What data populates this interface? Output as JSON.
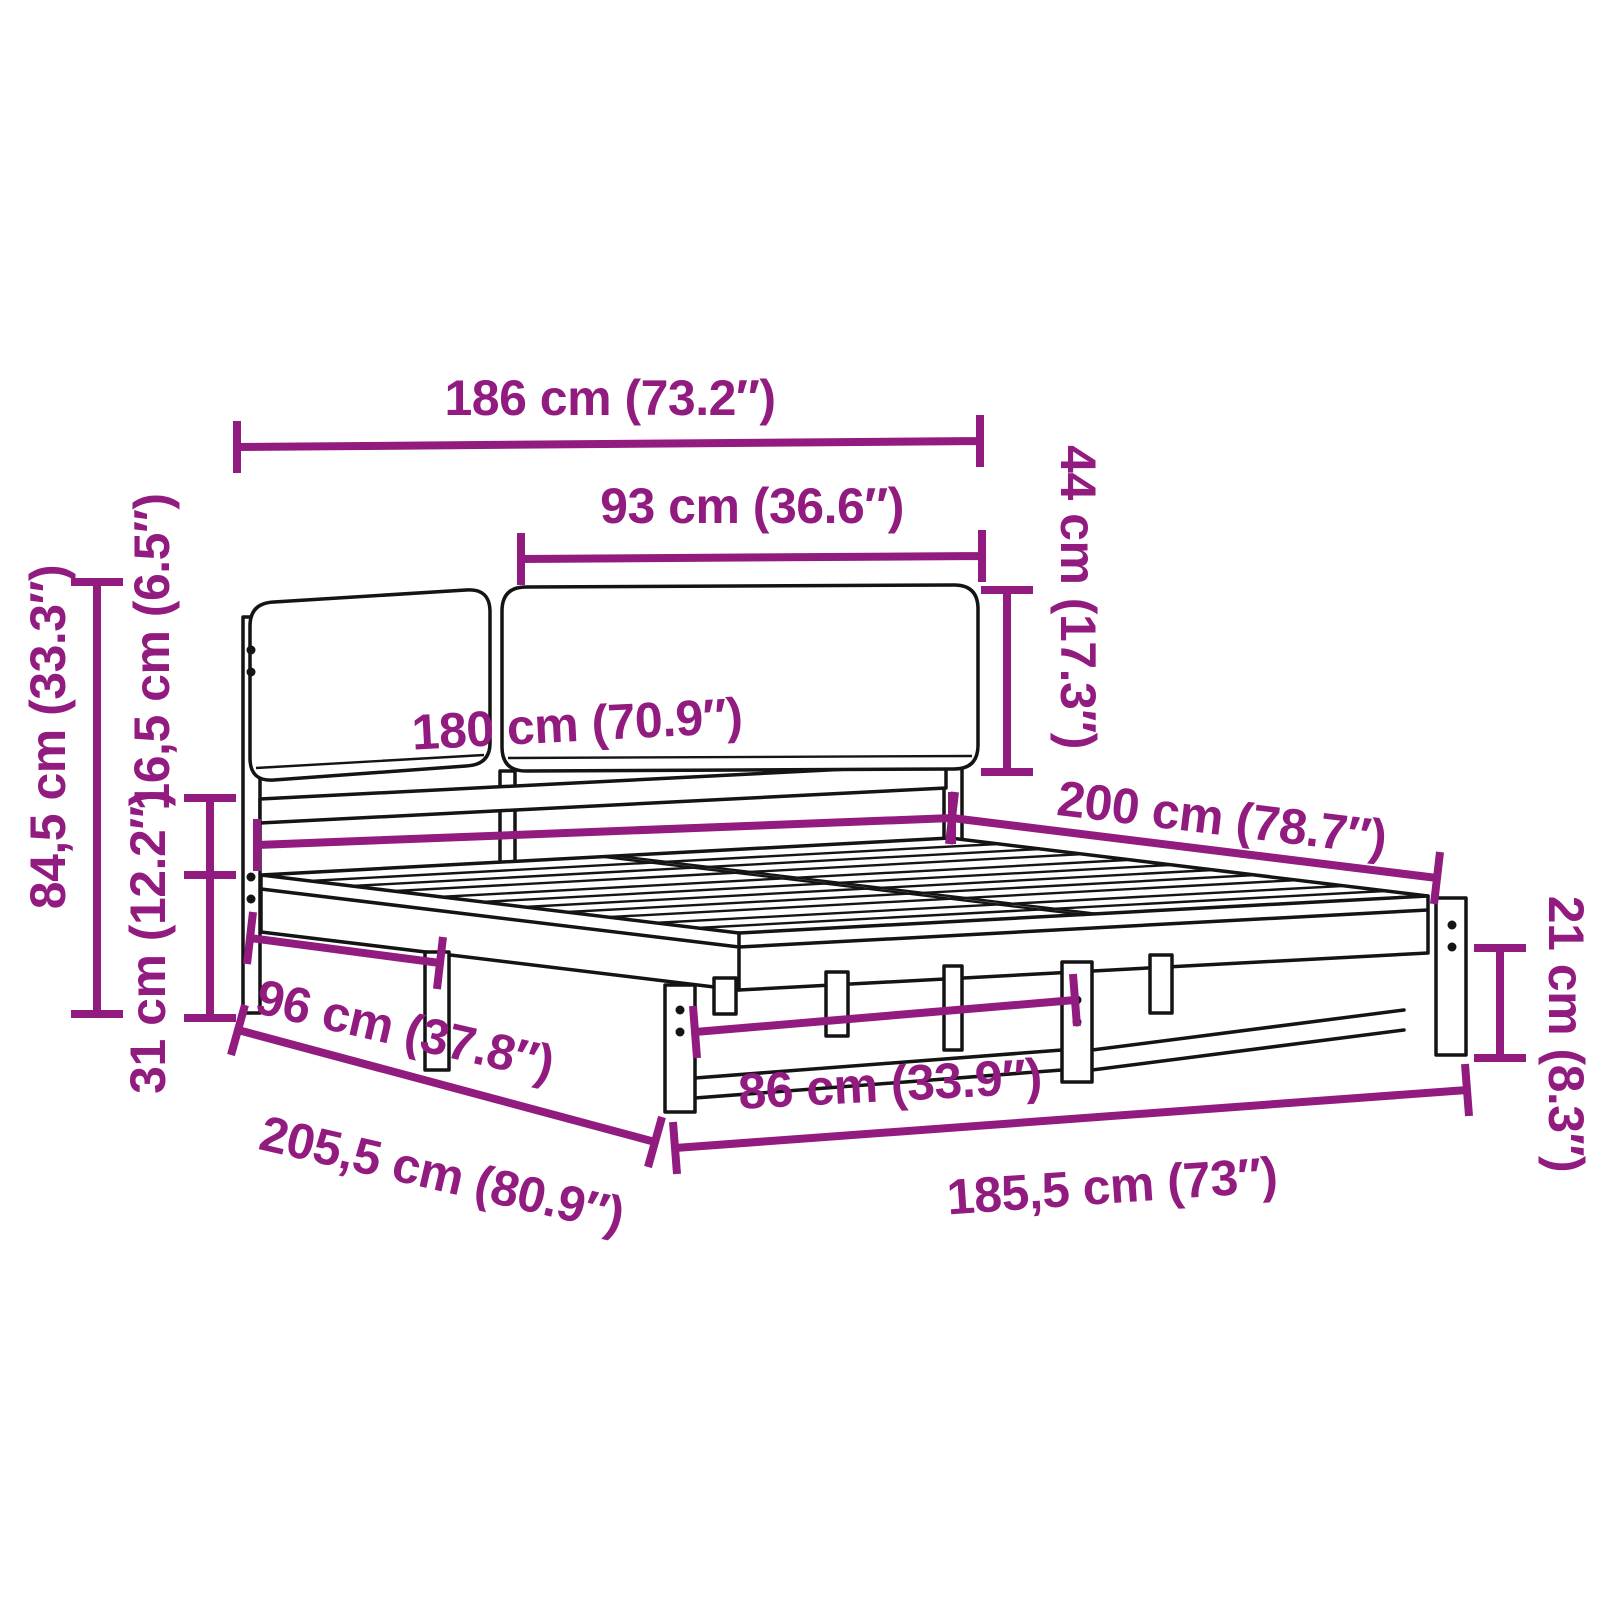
{
  "colors": {
    "dimension": "#921B7F",
    "line_art": "#141414",
    "background": "#FFFFFF"
  },
  "diagram": {
    "dimensions": {
      "headboard_width": "186 cm (73.2″)",
      "cushion_width": "93 cm (36.6″)",
      "cushion_height": "44 cm (17.3″)",
      "bed_width": "180 cm (70.9″)",
      "bed_length": "200 cm (78.7″)",
      "headboard_height": "84,5 cm (33.3″)",
      "rail_height": "16,5 cm (6.5″)",
      "under_bed_clearance": "31 cm (12.2″)",
      "headboard_section_depth": "96 cm (37.8″)",
      "leg_spacing": "86 cm (33.9″)",
      "base_width": "185,5 cm (73″)",
      "total_length": "205,5 cm (80.9″)",
      "foot_clearance": "21 cm (8.3″)"
    }
  }
}
